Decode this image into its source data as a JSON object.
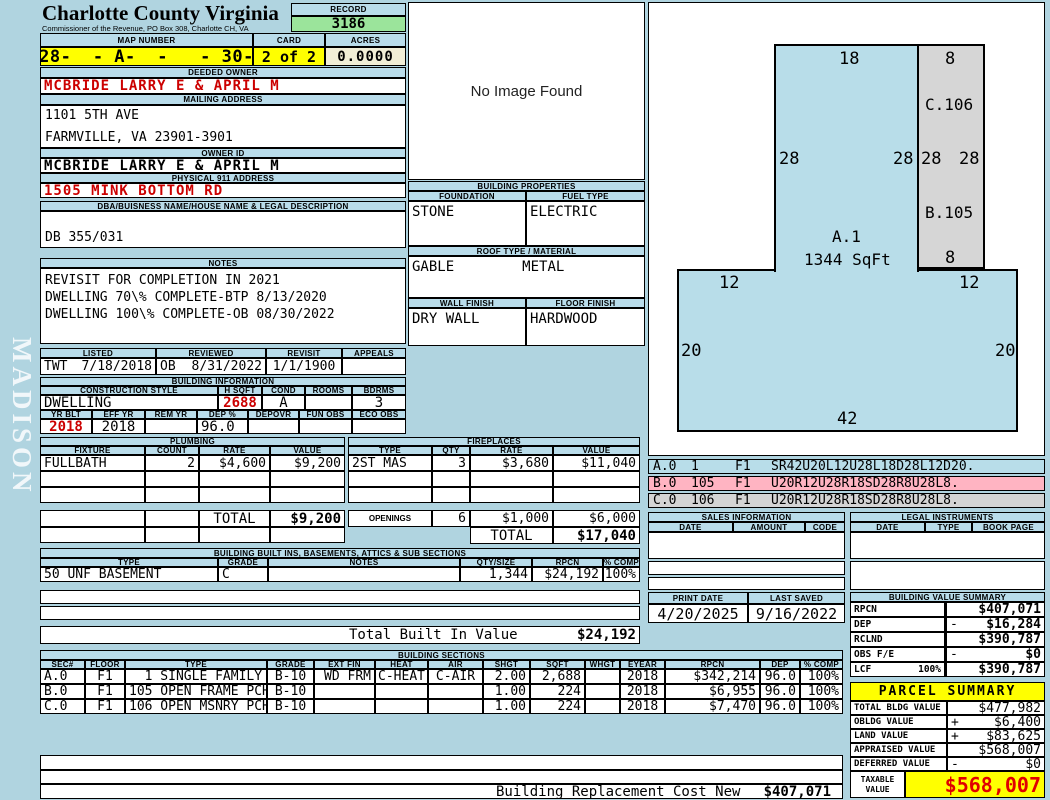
{
  "colors": {
    "highlight_yellow": "#ffff00",
    "record_green": "#9be49b",
    "alert_red": "#cc0000",
    "panel_blue": "#b9dcea",
    "legend_pink": "#ffb4c2",
    "legend_gray": "#d4d4d4"
  },
  "sidebar": {
    "watermark": "MADISON"
  },
  "header": {
    "county": "Charlotte County Virginia",
    "subtitle": "Commissioner of the Revenue, PO Box 308, Charlotte CH, VA",
    "record_label": "RECORD",
    "record_value": "3186",
    "map_label": "MAP NUMBER",
    "map_value": "028-  - A-  -   - 30-D",
    "card_label": "CARD",
    "card_value": "2 of 2",
    "acres_label": "ACRES",
    "acres_value": "0.0000"
  },
  "owner": {
    "deeded_label": "DEEDED OWNER",
    "deeded_value": "MCBRIDE LARRY E & APRIL M",
    "mailing_label": "MAILING ADDRESS",
    "mailing_line1": "1101 5TH AVE",
    "mailing_line2": "FARMVILLE, VA 23901-3901",
    "owner_id_label": "OWNER ID",
    "owner_id_value": "MCBRIDE LARRY E & APRIL M",
    "physical_label": "PHYSICAL 911 ADDRESS",
    "physical_value": "1505 MINK BOTTOM RD",
    "dba_label": "DBA/BUISNESS NAME/HOUSE NAME & LEGAL DESCRIPTION",
    "dba_value": "DB 355/031"
  },
  "notes": {
    "label": "NOTES",
    "line1": "REVISIT FOR COMPLETION IN 2021",
    "line2": "DWELLING 70\\% COMPLETE-BTP 8/13/2020",
    "line3": "DWELLING 100\\% COMPLETE-OB 08/30/2022"
  },
  "visits": {
    "listed_label": "LISTED",
    "reviewed_label": "REVIEWED",
    "revisit_label": "REVISIT",
    "appeals_label": "APPEALS",
    "listed_by": "TWT",
    "listed_date": "7/18/2018",
    "reviewed_by": "OB",
    "reviewed_date": "8/31/2022",
    "revisit_date": "1/1/1900",
    "appeals_value": ""
  },
  "building_info": {
    "title": "BUILDING INFORMATION",
    "style_label": "CONSTRUCTION STYLE",
    "hsqft_label": "H SQFT",
    "cond_label": "COND",
    "rooms_label": "ROOMS",
    "bdrms_label": "BDRMS",
    "style": "DWELLING",
    "hsqft": "2688",
    "cond": "A",
    "rooms": "",
    "bdrms": "3",
    "yrblt_label": "YR BLT",
    "effyr_label": "EFF YR",
    "remyr_label": "REM YR",
    "dep_label": "DEP %",
    "depovr_label": "DEPOVR",
    "funobs_label": "FUN OBS",
    "ecoobs_label": "ECO OBS",
    "yrblt": "2018",
    "effyr": "2018",
    "remyr": "",
    "dep": "96.0",
    "depovr": "",
    "funobs": "",
    "ecoobs": ""
  },
  "plumbing": {
    "title": "PLUMBING",
    "headers": [
      "FIXTURE",
      "COUNT",
      "RATE",
      "VALUE"
    ],
    "rows": [
      [
        "FULLBATH",
        "2",
        "$4,600",
        "$9,200"
      ]
    ],
    "total_label": "TOTAL",
    "total": "$9,200"
  },
  "fireplaces": {
    "title": "FIREPLACES",
    "headers": [
      "TYPE",
      "QTY",
      "RATE",
      "VALUE"
    ],
    "rows": [
      [
        "2ST MAS",
        "3",
        "$3,680",
        "$11,040"
      ]
    ],
    "openings_label": "OPENINGS",
    "openings_qty": "6",
    "openings_rate": "$1,000",
    "openings_value": "$6,000",
    "total_label": "TOTAL",
    "total": "$17,040"
  },
  "built_ins": {
    "title": "BUILDING BUILT INS, BASEMENTS, ATTICS & SUB SECTIONS",
    "headers": [
      "TYPE",
      "GRADE",
      "NOTES",
      "QTY/SIZE",
      "RPCN",
      "% COMP"
    ],
    "rows": [
      [
        "50 UNF BASEMENT",
        "C",
        "",
        "1,344",
        "$24,192",
        "100%"
      ]
    ],
    "total_label": "Total Built In Value",
    "total": "$24,192"
  },
  "building_sections": {
    "title": "BUILDING SECTIONS",
    "headers": [
      "SEC#",
      "FLOOR",
      "TYPE",
      "GRADE",
      "EXT FIN",
      "HEAT",
      "AIR",
      "SHGT",
      "SQFT",
      "WHGT",
      "EYEAR",
      "RPCN",
      "DEP",
      "% COMP"
    ],
    "rows": [
      [
        "A.0",
        "F1",
        "  1 SINGLE FAMILY",
        "B-10",
        "WD FRM",
        "C-HEAT",
        "C-AIR",
        "2.00",
        "2,688",
        "",
        "2018",
        "$342,214",
        "96.0",
        "100%"
      ],
      [
        "B.0",
        "F1",
        "105 OPEN FRAME PCH",
        "B-10",
        "",
        "",
        "",
        "1.00",
        "224",
        "",
        "2018",
        "$6,955",
        "96.0",
        "100%"
      ],
      [
        "C.0",
        "F1",
        "106 OPEN MSNRY PCH",
        "B-10",
        "",
        "",
        "",
        "1.00",
        "224",
        "",
        "2018",
        "$7,470",
        "96.0",
        "100%"
      ]
    ],
    "footer_label": "Building Replacement Cost New",
    "footer_value": "$407,071"
  },
  "image_box": {
    "placeholder": "No Image Found"
  },
  "building_properties": {
    "title": "BUILDING PROPERTIES",
    "foundation_label": "FOUNDATION",
    "fueltype_label": "FUEL TYPE",
    "foundation": "STONE",
    "fueltype": "ELECTRIC",
    "roof_label": "ROOF TYPE / MATERIAL",
    "roof_type": "GABLE",
    "roof_material": "METAL",
    "wall_label": "WALL FINISH",
    "floor_label": "FLOOR FINISH",
    "wall": "DRY WALL",
    "floor": "HARDWOOD"
  },
  "sketch": {
    "area_label": "A.1",
    "area_sqft": "1344 SqFt",
    "upper_top": "18",
    "gray_top": "8",
    "gray_upper_label": "C.106",
    "left_28": "28",
    "right_28": "28",
    "gray_left_28": "28",
    "gray_right_28": "28",
    "gray_lower_label": "B.105",
    "gray_bottom": "8",
    "lower_left_12": "12",
    "lower_right_12": "12",
    "lower_left_20": "20",
    "lower_right_20": "20",
    "lower_bottom": "42",
    "legend": [
      {
        "sec": "A.0",
        "code": "1",
        "floor": "F1",
        "trace": "SR42U20L12U28L18D28L12D20."
      },
      {
        "sec": "B.0",
        "code": "105",
        "floor": "F1",
        "trace": "U20R12U28R18SD28R8U28L8."
      },
      {
        "sec": "C.0",
        "code": "106",
        "floor": "F1",
        "trace": "U20R12U28R18SD28R8U28L8."
      }
    ]
  },
  "sales": {
    "title": "SALES INFORMATION",
    "headers": [
      "DATE",
      "AMOUNT",
      "CODE"
    ]
  },
  "legal": {
    "title": "LEGAL INSTRUMENTS",
    "headers": [
      "DATE",
      "TYPE",
      "BOOK PAGE"
    ]
  },
  "dates": {
    "print_label": "PRINT DATE",
    "print": "4/20/2025",
    "saved_label": "LAST SAVED",
    "saved": "9/16/2022"
  },
  "value_summary": {
    "title": "BUILDING VALUE SUMMARY",
    "rows": [
      {
        "label": "RPCN",
        "extra": "",
        "op": "",
        "value": "$407,071"
      },
      {
        "label": "DEP",
        "extra": "",
        "op": "-",
        "value": "$16,284"
      },
      {
        "label": "RCLND",
        "extra": "",
        "op": "",
        "value": "$390,787"
      },
      {
        "label": "OBS F/E",
        "extra": "",
        "op": "-",
        "value": "$0"
      },
      {
        "label": "LCF",
        "extra": "100%",
        "op": "",
        "value": "$390,787"
      }
    ]
  },
  "parcel_summary": {
    "title": "PARCEL SUMMARY",
    "rows": [
      {
        "label": "TOTAL BLDG VALUE",
        "op": "",
        "value": "$477,982"
      },
      {
        "label": "OBLDG VALUE",
        "op": "+",
        "value": "$6,400"
      },
      {
        "label": "LAND VALUE",
        "op": "+",
        "value": "$83,625"
      },
      {
        "label": "APPRAISED VALUE",
        "op": "",
        "value": "$568,007"
      },
      {
        "label": "DEFERRED VALUE",
        "op": "-",
        "value": "$0"
      }
    ],
    "taxable_label": "TAXABLE VALUE",
    "taxable_value": "$568,007"
  }
}
